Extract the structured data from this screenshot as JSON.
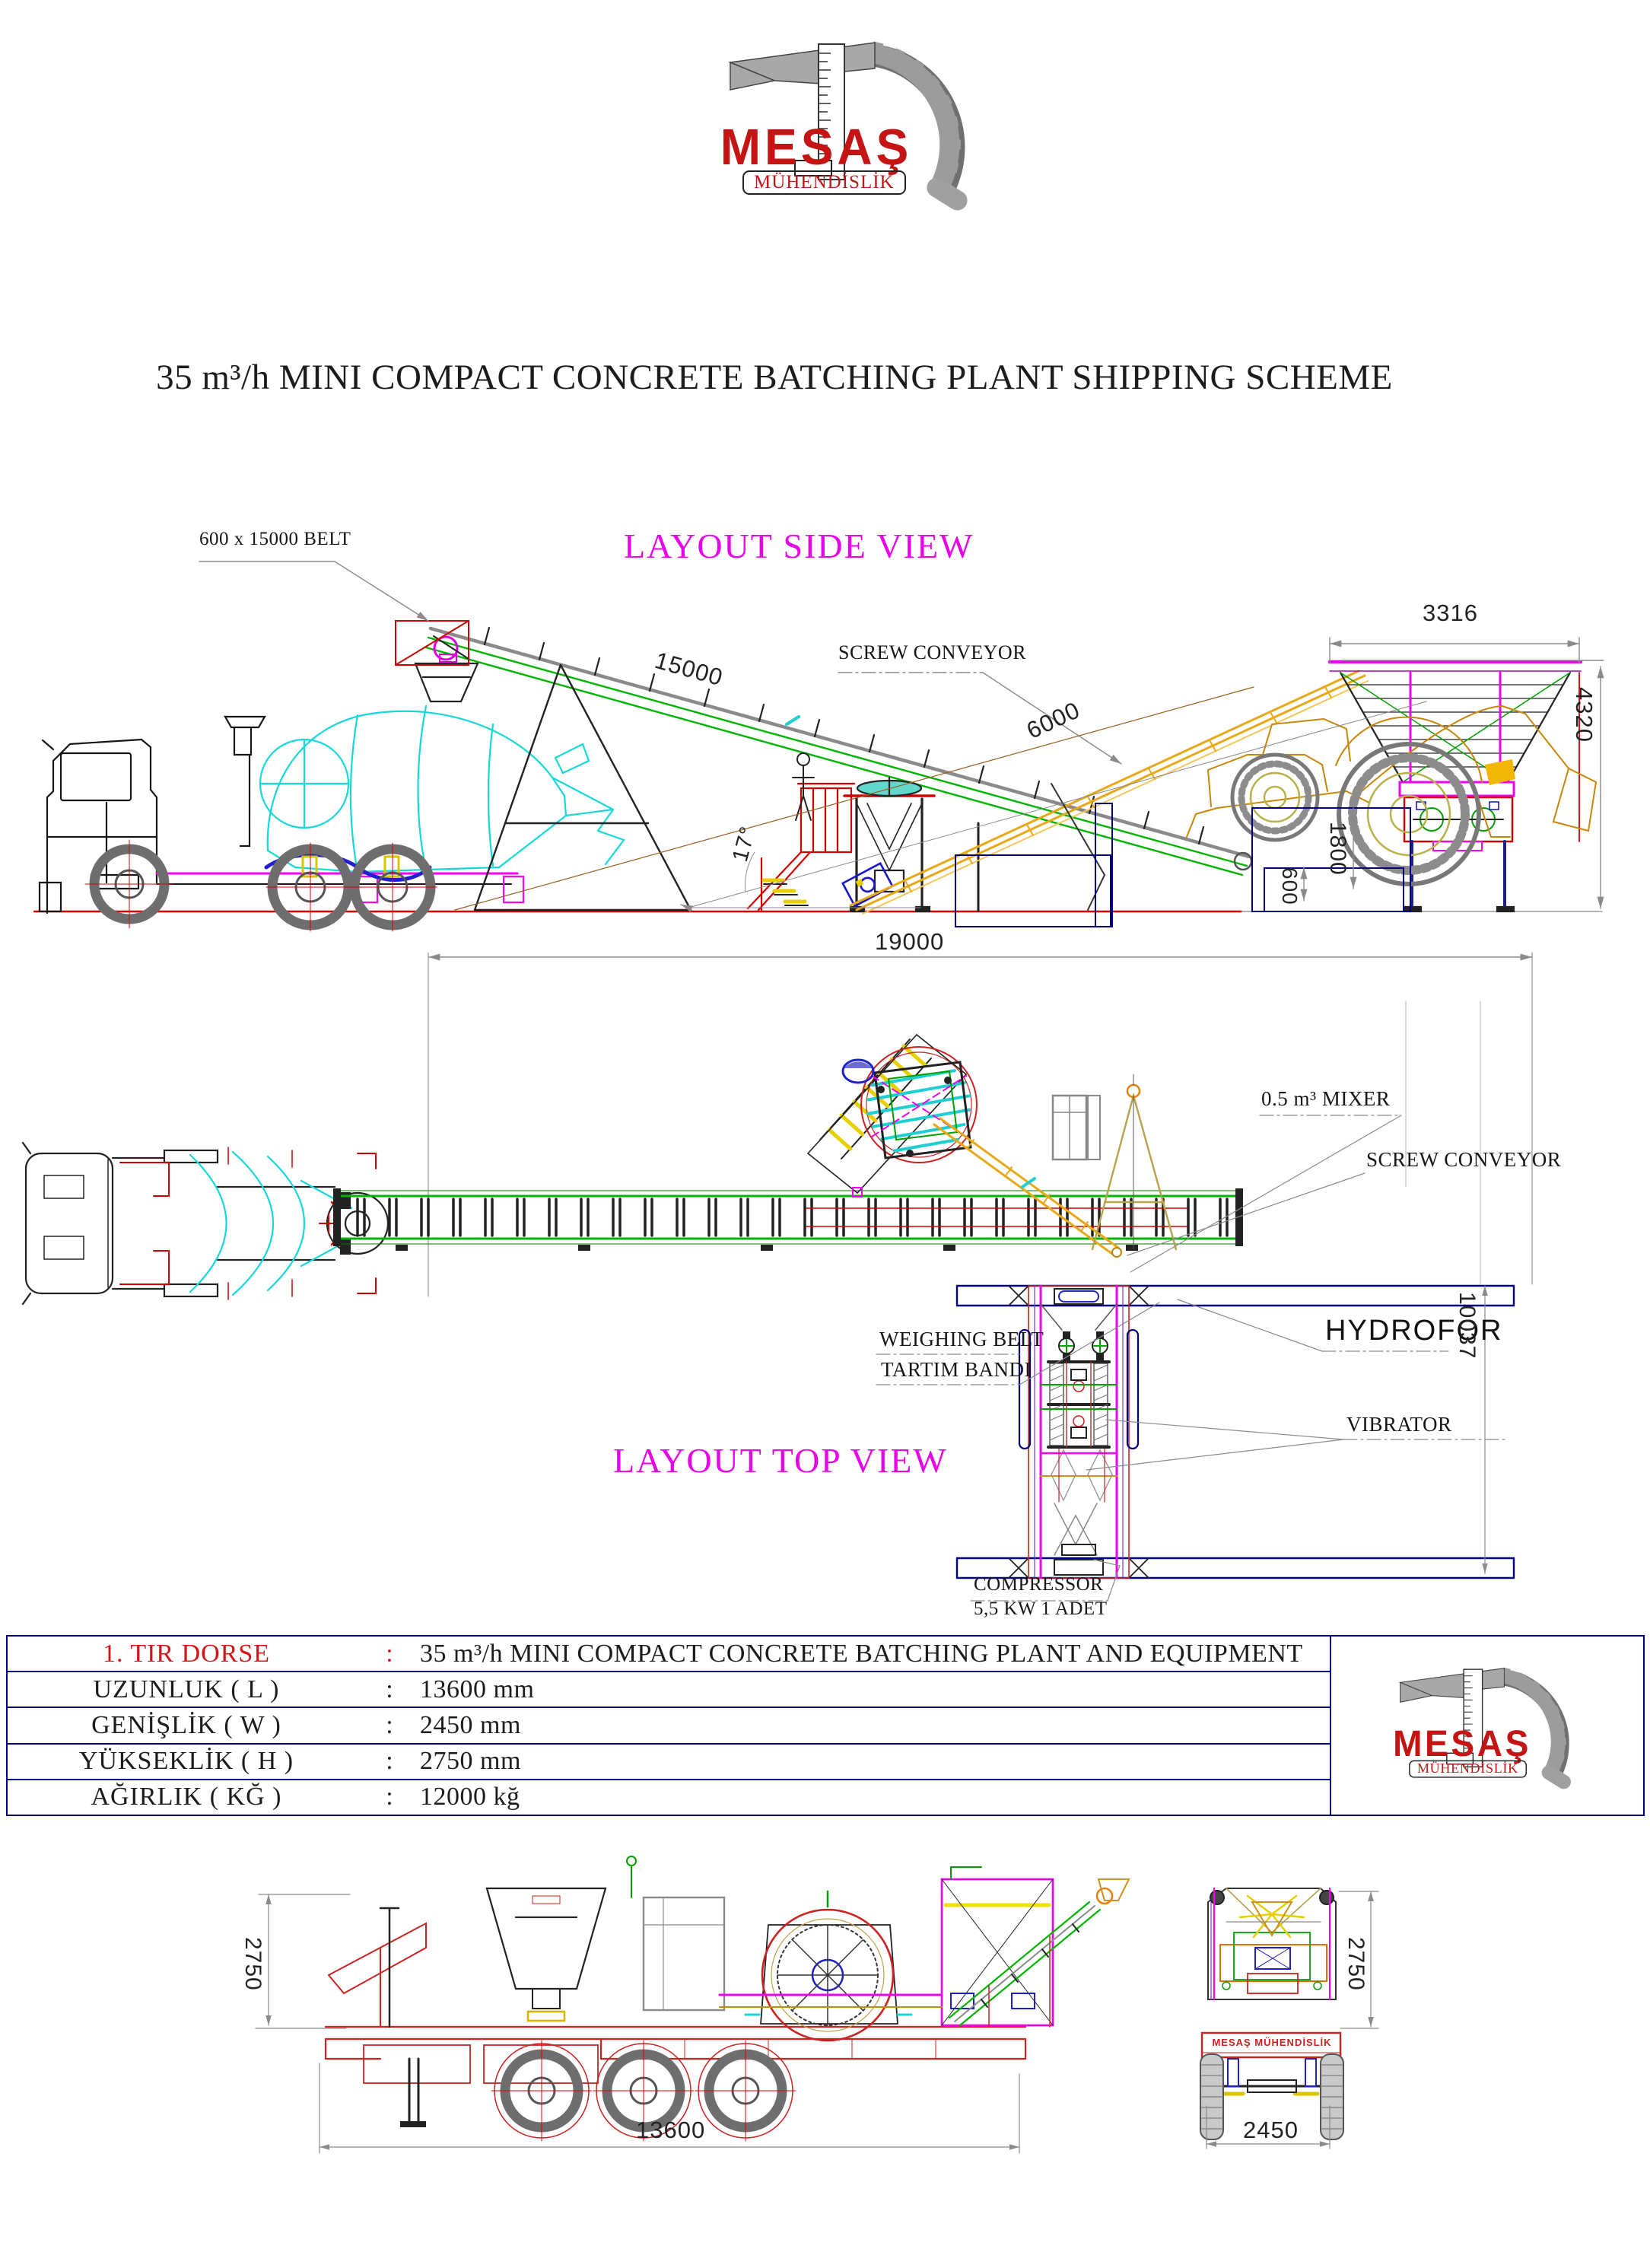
{
  "page": {
    "title": "35 m³/h MINI COMPACT CONCRETE BATCHING PLANT SHIPPING SCHEME"
  },
  "logo": {
    "name": "MESAŞ",
    "subtitle": "MÜHENDİSLİK"
  },
  "side_view": {
    "heading": "LAYOUT SIDE VIEW",
    "belt_label": "600 x 15000 BELT",
    "screw_label": "SCREW CONVEYOR",
    "dim_belt_length": "15000",
    "dim_screw_length": "6000",
    "dim_hopper_width": "3316",
    "dim_overall_height": "4320",
    "dim_discharge_height": "1800",
    "dim_clearance": "600",
    "dim_belt_angle": "17°"
  },
  "top_view": {
    "heading": "LAYOUT TOP VIEW",
    "mixer_label": "0.5 m³ MIXER",
    "screw_label": "SCREW CONVEYOR",
    "hydrofor_label": "HYDROFOR",
    "weighing_belt_label_en": "WEIGHING BELT",
    "weighing_belt_label_tr": "TARTIM BANDI",
    "vibrator_label": "VIBRATOR",
    "compressor_label": "COMPRESSOR",
    "compressor_spec": "5,5 KW 1 ADET",
    "dim_total_length": "19000",
    "dim_plant_length": "10037"
  },
  "table": {
    "rows": [
      {
        "label": "1. TIR DORSE",
        "sep": ":",
        "value": "35 m³/h MINI COMPACT CONCRETE BATCHING PLANT AND EQUIPMENT"
      },
      {
        "label": "UZUNLUK ( L )",
        "sep": ":",
        "value": "13600 mm"
      },
      {
        "label": "GENİŞLİK ( W )",
        "sep": ":",
        "value": "2450 mm"
      },
      {
        "label": "YÜKSEKLİK ( H )",
        "sep": ":",
        "value": "2750 mm"
      },
      {
        "label": "AĞIRLIK ( KĞ )",
        "sep": ":",
        "value": "12000 kğ"
      }
    ]
  },
  "shipping": {
    "dim_trailer_height_side": "2750",
    "dim_trailer_length": "13600",
    "dim_trailer_height_rear": "2750",
    "dim_trailer_width": "2450",
    "trailer_marking": "MESAŞ MÜHENDİSLİK"
  },
  "colors": {
    "heading_magenta": "#e800e8",
    "logo_red": "#c41414",
    "table_navy": "#000080",
    "drawing_red": "#d00000",
    "belt_green": "#00b400",
    "drum_cyan": "#17d8d8",
    "screw_yellow": "#e8a818",
    "loader_orange": "#c8860a",
    "dim_gray": "#8a8a8a"
  }
}
